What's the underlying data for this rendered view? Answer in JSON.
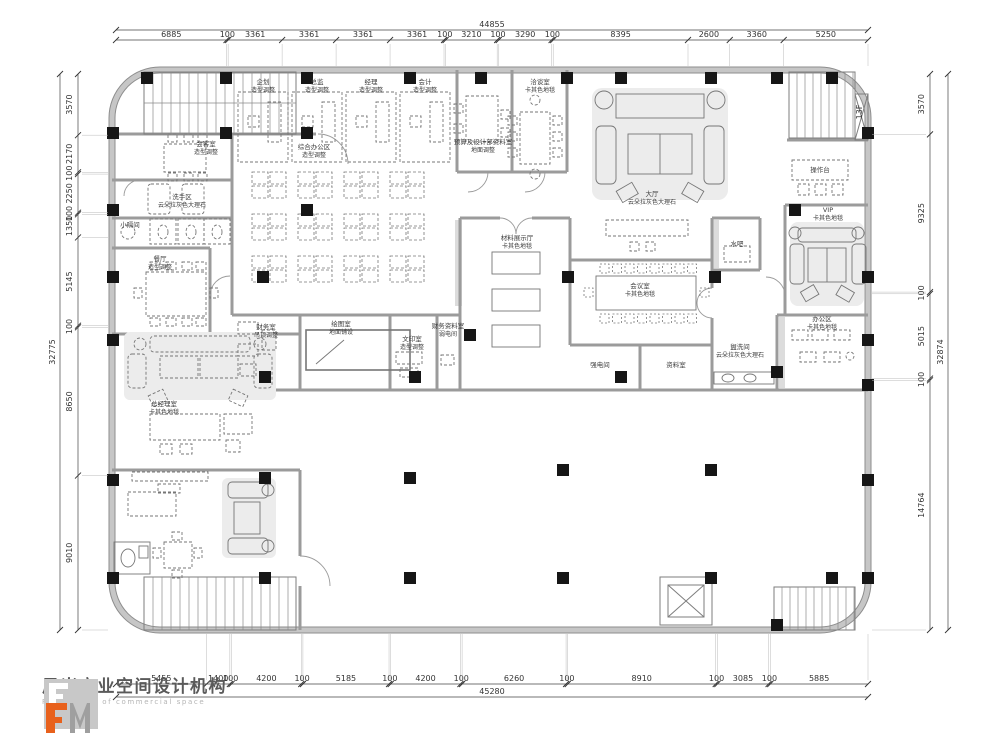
{
  "drawing": {
    "floor_tag": "13F"
  },
  "dimensions": {
    "top": {
      "total": "44855",
      "segments": [
        "6885",
        "100",
        "3361",
        "3361",
        "3361",
        "3361",
        "100",
        "3210",
        "100",
        "3290",
        "100",
        "8395",
        "2600",
        "3360",
        "5250"
      ]
    },
    "bottom": {
      "total": "45280",
      "segments": [
        "5455",
        "1400",
        "100",
        "4200",
        "100",
        "5185",
        "100",
        "4200",
        "100",
        "6260",
        "100",
        "8910",
        "100",
        "3085",
        "100",
        "5885"
      ]
    },
    "left": {
      "total": "32775",
      "segments": [
        "3570",
        "2170",
        "100",
        "2250",
        "100",
        "1350",
        "5145",
        "100",
        "8650",
        "9010"
      ]
    },
    "right": {
      "total": "32874",
      "segments": [
        "3570",
        "9325",
        "100",
        "5015",
        "100",
        "14764"
      ]
    }
  },
  "rooms": [
    {
      "name": "企划",
      "note": "造型调整",
      "x": 263,
      "y": 84
    },
    {
      "name": "总监",
      "note": "造型调整",
      "x": 317,
      "y": 84
    },
    {
      "name": "经理",
      "note": "造型调整",
      "x": 371,
      "y": 84
    },
    {
      "name": "会计",
      "note": "造型调整",
      "x": 425,
      "y": 84
    },
    {
      "name": "综合办公区",
      "note": "造型调整",
      "x": 314,
      "y": 149
    },
    {
      "name": "预算及设计部资料室",
      "note": "地面调整",
      "x": 483,
      "y": 144
    },
    {
      "name": "洽谈室",
      "note": "卡其色地毯",
      "x": 540,
      "y": 84
    },
    {
      "name": "大厅",
      "note": "云朵拉灰色大理石",
      "x": 652,
      "y": 196
    },
    {
      "name": "操作台",
      "note": "",
      "x": 820,
      "y": 172
    },
    {
      "name": "VIP",
      "note": "卡其色地毯",
      "x": 828,
      "y": 212
    },
    {
      "name": "会议室",
      "note": "卡其色地毯",
      "x": 640,
      "y": 288
    },
    {
      "name": "水吧",
      "note": "",
      "x": 737,
      "y": 246
    },
    {
      "name": "材料展示厅",
      "note": "卡其色地毯",
      "x": 517,
      "y": 240
    },
    {
      "name": "会客室",
      "note": "造型调整",
      "x": 206,
      "y": 146
    },
    {
      "name": "洗手区",
      "note": "云朵拉灰色大理石",
      "x": 182,
      "y": 199
    },
    {
      "name": "小隔间",
      "note": "",
      "x": 130,
      "y": 227
    },
    {
      "name": "餐厅",
      "note": "造型调整",
      "x": 160,
      "y": 261
    },
    {
      "name": "总经理室",
      "note": "卡其色地毯",
      "x": 164,
      "y": 406
    },
    {
      "name": "财务室",
      "note": "吊顶调整",
      "x": 266,
      "y": 329
    },
    {
      "name": "绘图室",
      "note": "地面铺设",
      "x": 341,
      "y": 326
    },
    {
      "name": "文印室",
      "note": "造型调整",
      "x": 412,
      "y": 341
    },
    {
      "name": "财务资料室",
      "note": "弱电间",
      "x": 448,
      "y": 328
    },
    {
      "name": "强电间",
      "note": "",
      "x": 600,
      "y": 367
    },
    {
      "name": "资料室",
      "note": "",
      "x": 676,
      "y": 367
    },
    {
      "name": "盥洗间",
      "note": "云朵拉灰色大理石",
      "x": 740,
      "y": 349
    },
    {
      "name": "办公区",
      "note": "卡其色地毯",
      "x": 822,
      "y": 321
    }
  ],
  "columns": [
    [
      147,
      78
    ],
    [
      226,
      78
    ],
    [
      307,
      78
    ],
    [
      410,
      78
    ],
    [
      481,
      78
    ],
    [
      567,
      78
    ],
    [
      621,
      78
    ],
    [
      711,
      78
    ],
    [
      777,
      78
    ],
    [
      832,
      78
    ],
    [
      113,
      133
    ],
    [
      226,
      133
    ],
    [
      307,
      133
    ],
    [
      868,
      133
    ],
    [
      113,
      210
    ],
    [
      307,
      210
    ],
    [
      795,
      210
    ],
    [
      113,
      277
    ],
    [
      263,
      277
    ],
    [
      568,
      277
    ],
    [
      715,
      277
    ],
    [
      868,
      277
    ],
    [
      113,
      340
    ],
    [
      868,
      340
    ],
    [
      265,
      377
    ],
    [
      415,
      377
    ],
    [
      470,
      335
    ],
    [
      621,
      377
    ],
    [
      777,
      372
    ],
    [
      868,
      385
    ],
    [
      113,
      480
    ],
    [
      265,
      478
    ],
    [
      410,
      478
    ],
    [
      563,
      470
    ],
    [
      711,
      470
    ],
    [
      868,
      480
    ],
    [
      113,
      578
    ],
    [
      265,
      578
    ],
    [
      410,
      578
    ],
    [
      563,
      578
    ],
    [
      711,
      578
    ],
    [
      832,
      578
    ],
    [
      777,
      625
    ],
    [
      868,
      578
    ]
  ],
  "logo": {
    "company_cn": "风米商业空间设计机构",
    "company_en": "F. M design of commercial space",
    "accent": "#e8611c",
    "gray": "#9a9a9a"
  }
}
